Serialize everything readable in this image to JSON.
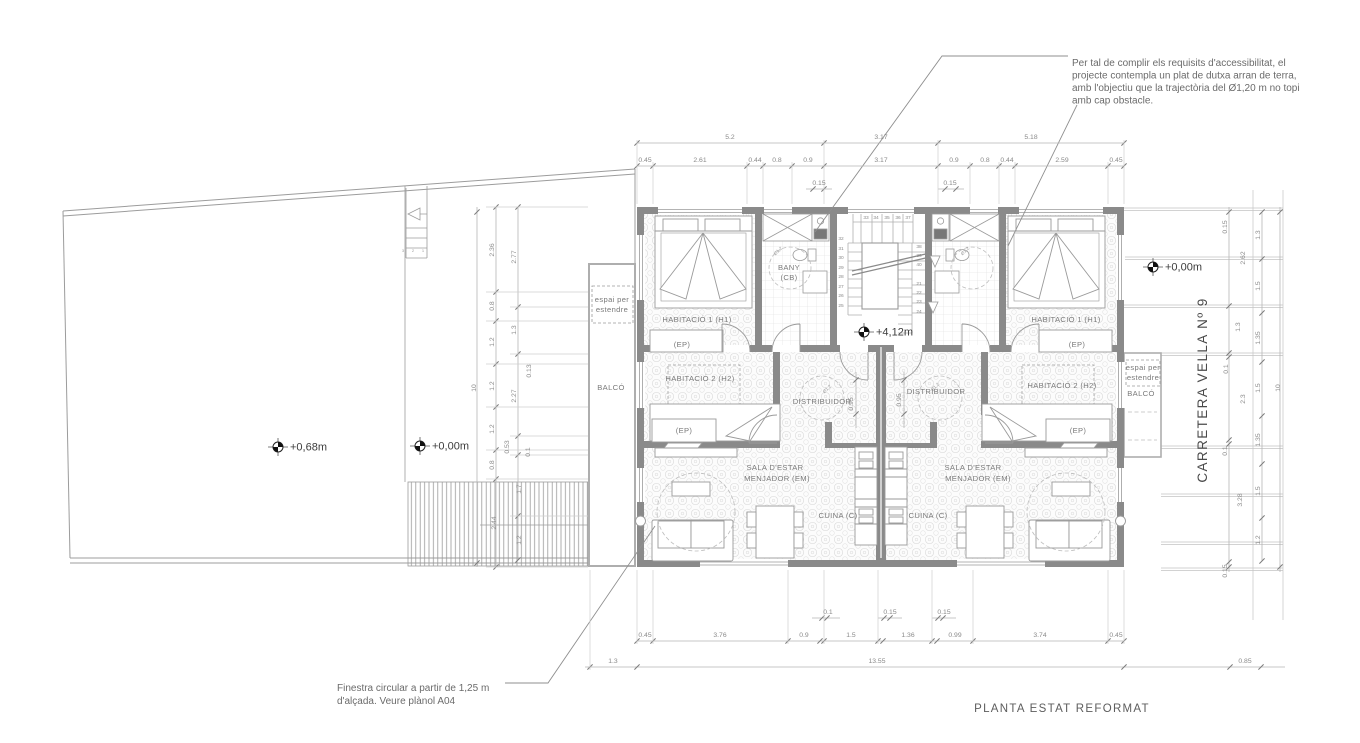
{
  "drawing": {
    "title": "PLANTA ESTAT REFORMAT",
    "street_label": "CARRETERA VELLA Nº 9"
  },
  "notes": {
    "accessibility": [
      "Per tal de complir els requisits d'accessibilitat, el",
      "projecte contempla un plat de dutxa arran de terra,",
      "amb l'objectiu que la trajectòria del Ø1,20 m no topi",
      "amb cap obstacle."
    ],
    "circular_window": [
      "Finestra circular a partir de 1,25 m",
      "d'alçada. Veure plànol A04"
    ]
  },
  "levels": [
    {
      "label": "+0,68m",
      "x": 278,
      "y": 447
    },
    {
      "label": "+0,00m",
      "x": 420,
      "y": 446
    },
    {
      "label": "+4,12m",
      "x": 864,
      "y": 332
    },
    {
      "label": "+0,00m",
      "x": 1153,
      "y": 267
    }
  ],
  "rooms": [
    {
      "label": "HABITACIÓ 1 (H1)",
      "x": 697,
      "y": 322
    },
    {
      "label": "(EP)",
      "x": 682,
      "y": 347
    },
    {
      "label": "BANY",
      "x": 789,
      "y": 270
    },
    {
      "label": "(CB)",
      "x": 789,
      "y": 280
    },
    {
      "label": "HABITACIÓ 2 (H2)",
      "x": 700,
      "y": 381
    },
    {
      "label": "(EP)",
      "x": 684,
      "y": 433
    },
    {
      "label": "DISTRIBUIDOR",
      "x": 822,
      "y": 404
    },
    {
      "label": "SALA D'ESTAR",
      "x": 775,
      "y": 470
    },
    {
      "label": "MENJADOR (EM)",
      "x": 777,
      "y": 481
    },
    {
      "label": "CUINA (C)",
      "x": 838,
      "y": 518
    },
    {
      "label": "CUINA (C)",
      "x": 928,
      "y": 518
    },
    {
      "label": "SALA D'ESTAR",
      "x": 973,
      "y": 470
    },
    {
      "label": "MENJADOR (EM)",
      "x": 978,
      "y": 481
    },
    {
      "label": "DISTRIBUIDOR",
      "x": 936,
      "y": 394
    },
    {
      "label": "HABITACIÓ 2 (H2)",
      "x": 1062,
      "y": 388
    },
    {
      "label": "(EP)",
      "x": 1078,
      "y": 433
    },
    {
      "label": "HABITACIÓ 1 (H1)",
      "x": 1066,
      "y": 322
    },
    {
      "label": "(EP)",
      "x": 1077,
      "y": 347
    },
    {
      "label": "BALCÓ",
      "x": 611,
      "y": 390
    },
    {
      "label": "espai per",
      "x": 612,
      "y": 302
    },
    {
      "label": "estendre",
      "x": 612,
      "y": 312
    },
    {
      "label": "espai per",
      "x": 1143,
      "y": 370
    },
    {
      "label": "estendre",
      "x": 1143,
      "y": 380
    },
    {
      "label": "BALCÓ",
      "x": 1141,
      "y": 396
    }
  ],
  "turning_circle_labels": [
    {
      "label": "Ø1,2",
      "x": 779,
      "y": 252
    },
    {
      "label": "Ø1,2",
      "x": 966,
      "y": 252
    },
    {
      "label": "Ø1,2",
      "x": 828,
      "y": 390
    },
    {
      "label": "Ø1,2",
      "x": 936,
      "y": 388
    }
  ],
  "dimensions": {
    "top": [
      {
        "v": "5.2",
        "x": 730,
        "y": 139
      },
      {
        "v": "3.17",
        "x": 881,
        "y": 139
      },
      {
        "v": "5.18",
        "x": 1031,
        "y": 139
      },
      {
        "v": "0.45",
        "x": 645,
        "y": 162
      },
      {
        "v": "2.61",
        "x": 700,
        "y": 162
      },
      {
        "v": "0.44",
        "x": 755,
        "y": 162
      },
      {
        "v": "0.8",
        "x": 777,
        "y": 162
      },
      {
        "v": "0.9",
        "x": 808,
        "y": 162
      },
      {
        "v": "3.17",
        "x": 881,
        "y": 162
      },
      {
        "v": "0.9",
        "x": 954,
        "y": 162
      },
      {
        "v": "0.8",
        "x": 985,
        "y": 162
      },
      {
        "v": "0.44",
        "x": 1007,
        "y": 162
      },
      {
        "v": "2.59",
        "x": 1062,
        "y": 162
      },
      {
        "v": "0.45",
        "x": 1116,
        "y": 162
      },
      {
        "v": "0.15",
        "x": 819,
        "y": 185
      },
      {
        "v": "0.15",
        "x": 950,
        "y": 185
      }
    ],
    "bottom": [
      {
        "v": "0.1",
        "x": 828,
        "y": 614
      },
      {
        "v": "0.15",
        "x": 890,
        "y": 614
      },
      {
        "v": "0.15",
        "x": 944,
        "y": 614
      },
      {
        "v": "0.45",
        "x": 645,
        "y": 637
      },
      {
        "v": "3.76",
        "x": 720,
        "y": 637
      },
      {
        "v": "0.9",
        "x": 804,
        "y": 637
      },
      {
        "v": "1.5",
        "x": 851,
        "y": 637
      },
      {
        "v": "1.36",
        "x": 908,
        "y": 637
      },
      {
        "v": "0.99",
        "x": 955,
        "y": 637
      },
      {
        "v": "3.74",
        "x": 1040,
        "y": 637
      },
      {
        "v": "0.45",
        "x": 1116,
        "y": 637
      },
      {
        "v": "1.3",
        "x": 613,
        "y": 663
      },
      {
        "v": "13.55",
        "x": 877,
        "y": 663
      },
      {
        "v": "0.85",
        "x": 1245,
        "y": 663
      }
    ],
    "left": [
      {
        "v": "10",
        "x": 476,
        "y": 388
      },
      {
        "v": "2.36",
        "x": 494,
        "y": 250
      },
      {
        "v": "0.8",
        "x": 494,
        "y": 306
      },
      {
        "v": "1.2",
        "x": 494,
        "y": 342
      },
      {
        "v": "1.2",
        "x": 494,
        "y": 386
      },
      {
        "v": "1.2",
        "x": 494,
        "y": 429
      },
      {
        "v": "0.8",
        "x": 494,
        "y": 465
      },
      {
        "v": "2.44",
        "x": 496,
        "y": 523
      },
      {
        "v": "2.77",
        "x": 516,
        "y": 257
      },
      {
        "v": "1.3",
        "x": 516,
        "y": 330
      },
      {
        "v": "2.27",
        "x": 516,
        "y": 396
      },
      {
        "v": "0.53",
        "x": 509,
        "y": 447
      },
      {
        "v": "1.7",
        "x": 521,
        "y": 489
      },
      {
        "v": "1.2",
        "x": 521,
        "y": 540
      },
      {
        "v": "0.13",
        "x": 531,
        "y": 371
      },
      {
        "v": "0.1",
        "x": 530,
        "y": 452
      }
    ],
    "right": [
      {
        "v": "0.15",
        "x": 1227,
        "y": 227
      },
      {
        "v": "2.62",
        "x": 1245,
        "y": 258
      },
      {
        "v": "1.3",
        "x": 1240,
        "y": 327
      },
      {
        "v": "0.1",
        "x": 1228,
        "y": 369
      },
      {
        "v": "2.3",
        "x": 1245,
        "y": 399
      },
      {
        "v": "0.1",
        "x": 1227,
        "y": 451
      },
      {
        "v": "3.28",
        "x": 1242,
        "y": 500
      },
      {
        "v": "0.15",
        "x": 1227,
        "y": 571
      },
      {
        "v": "1.3",
        "x": 1260,
        "y": 235
      },
      {
        "v": "1.5",
        "x": 1260,
        "y": 286
      },
      {
        "v": "1.35",
        "x": 1260,
        "y": 338
      },
      {
        "v": "1.5",
        "x": 1260,
        "y": 388
      },
      {
        "v": "1.35",
        "x": 1260,
        "y": 440
      },
      {
        "v": "1.5",
        "x": 1260,
        "y": 491
      },
      {
        "v": "1.2",
        "x": 1260,
        "y": 540
      },
      {
        "v": "10",
        "x": 1280,
        "y": 388
      }
    ],
    "inner": [
      {
        "v": "0.95",
        "x": 853,
        "y": 404
      },
      {
        "v": "0.95",
        "x": 901,
        "y": 400
      }
    ]
  },
  "stair_numbers": {
    "top": [
      {
        "n": "33",
        "x": 866,
        "y": 219
      },
      {
        "n": "34",
        "x": 876,
        "y": 219
      },
      {
        "n": "35",
        "x": 887,
        "y": 219
      },
      {
        "n": "36",
        "x": 898,
        "y": 219
      },
      {
        "n": "37",
        "x": 908,
        "y": 219
      }
    ],
    "left": [
      {
        "n": "32",
        "x": 841,
        "y": 240
      },
      {
        "n": "31",
        "x": 841,
        "y": 250
      },
      {
        "n": "30",
        "x": 841,
        "y": 259
      },
      {
        "n": "29",
        "x": 841,
        "y": 269
      },
      {
        "n": "28",
        "x": 841,
        "y": 278
      },
      {
        "n": "27",
        "x": 841,
        "y": 288
      },
      {
        "n": "26",
        "x": 841,
        "y": 297
      },
      {
        "n": "25",
        "x": 841,
        "y": 307
      }
    ],
    "right": [
      {
        "n": "38",
        "x": 919,
        "y": 248
      },
      {
        "n": "39",
        "x": 919,
        "y": 257
      },
      {
        "n": "40",
        "x": 919,
        "y": 266
      },
      {
        "n": "21",
        "x": 919,
        "y": 285
      },
      {
        "n": "22",
        "x": 919,
        "y": 294
      },
      {
        "n": "23",
        "x": 919,
        "y": 303
      },
      {
        "n": "24",
        "x": 919,
        "y": 313
      }
    ],
    "terrace": [
      {
        "n": "3",
        "x": 403,
        "y": 252
      },
      {
        "n": "2",
        "x": 413,
        "y": 252
      },
      {
        "n": "1",
        "x": 423,
        "y": 252
      }
    ]
  }
}
